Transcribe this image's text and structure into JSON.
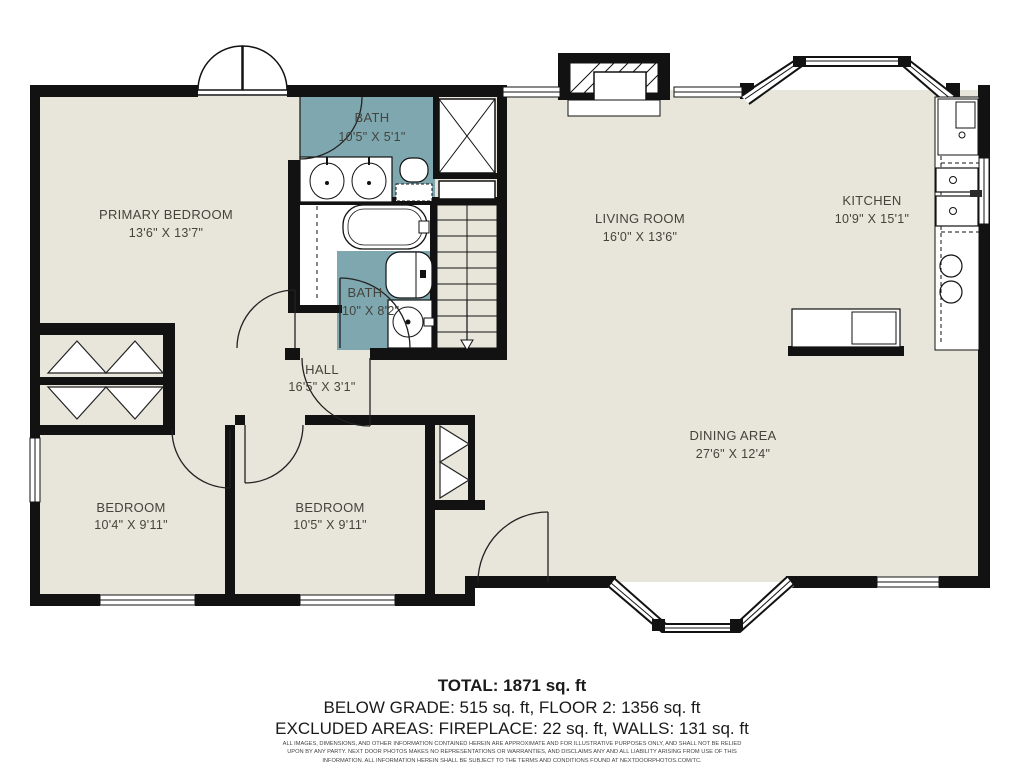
{
  "rooms": [
    {
      "name": "PRIMARY BEDROOM",
      "dims": "13'6\" X 13'7\""
    },
    {
      "name": "BATH",
      "dims": "10'5\" X 5'1\""
    },
    {
      "name": "LIVING ROOM",
      "dims": "16'0\" X 13'6\""
    },
    {
      "name": "KITCHEN",
      "dims": "10'9\" X 15'1\""
    },
    {
      "name": "BATH",
      "dims": "10\" X 8'2\""
    },
    {
      "name": "HALL",
      "dims": "16'5\" X 3'1\""
    },
    {
      "name": "BEDROOM",
      "dims": "10'4\" X 9'11\""
    },
    {
      "name": "BEDROOM",
      "dims": "10'5\" X 9'11\""
    },
    {
      "name": "DINING AREA",
      "dims": "27'6\" X 12'4\""
    }
  ],
  "summary": {
    "total": "TOTAL: 1871 sq. ft",
    "line2": "BELOW GRADE: 515 sq. ft, FLOOR 2: 1356 sq. ft",
    "line3": "EXCLUDED AREAS: FIREPLACE: 22 sq. ft, WALLS: 131 sq. ft"
  },
  "disclaimer": "ALL IMAGES, DIMENSIONS, AND OTHER INFORMATION CONTAINED HEREIN ARE APPROXIMATE AND FOR ILLUSTRATIVE PURPOSES ONLY, AND SHALL NOT BE RELIED UPON BY ANY PARTY. NEXT DOOR PHOTOS MAKES NO REPRESENTATIONS OR WARRANTIES, AND DISCLAIMS ANY AND ALL LIABILITY ARISING FROM USE OF THIS INFORMATION. ALL INFORMATION HEREIN SHALL BE SUBJECT TO THE TERMS AND CONDITIONS FOUND AT NEXTDOORPHOTOS.COM/TC.",
  "colors": {
    "floor": "#e8e6da",
    "bath": "#7ea7b0",
    "wall": "#121212",
    "label_text": "#45443c"
  }
}
